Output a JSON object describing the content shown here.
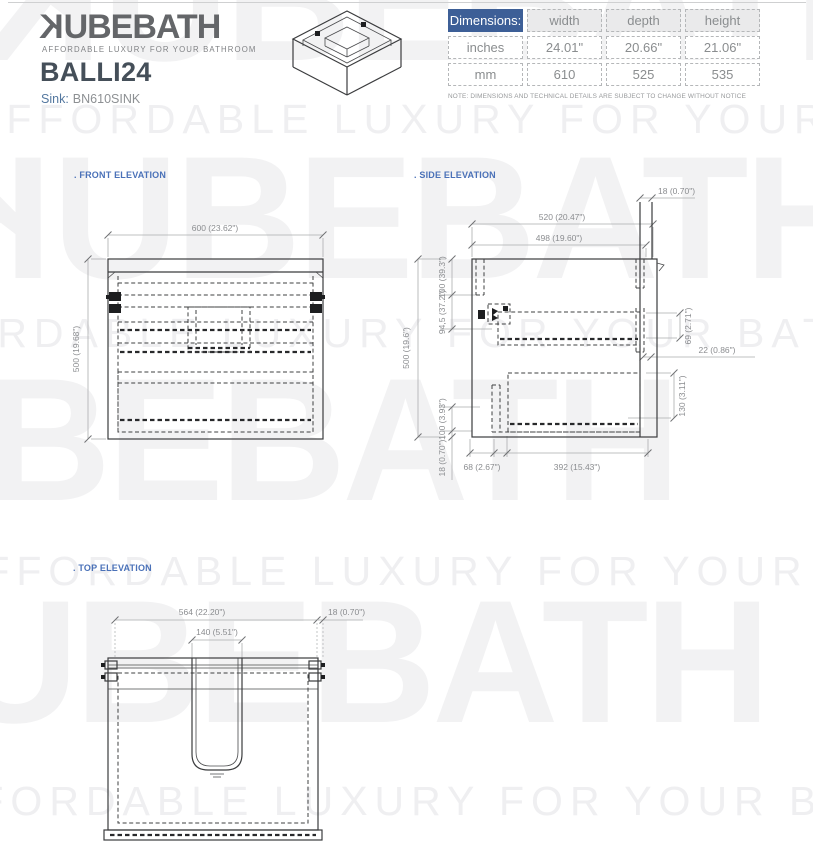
{
  "brand": {
    "logo_k": "K",
    "logo_rest": "UBEBATH",
    "tagline": "AFFORDABLE LUXURY FOR YOUR BATHROOM",
    "model": "BALLI24",
    "sink_label": "Sink:",
    "sink_value": "BN610SINK"
  },
  "spec_table": {
    "title": "Dimensions:",
    "columns": [
      "width",
      "depth",
      "height"
    ],
    "rows": [
      {
        "label": "inches",
        "values": [
          "24.01\"",
          "20.66\"",
          "21.06\""
        ]
      },
      {
        "label": "mm",
        "values": [
          "610",
          "525",
          "535"
        ]
      }
    ],
    "note": "NOTE: DIMENSIONS AND TECHNICAL DETAILS ARE SUBJECT TO CHANGE WITHOUT NOTICE"
  },
  "sections": {
    "front": ". FRONT ELEVATION",
    "side": ". SIDE ELEVATION",
    "top": ". TOP ELEVATION"
  },
  "front_dims": {
    "width": "600 (23.62\")",
    "height": "500 (19.68\")"
  },
  "side_dims": {
    "top_panel": "18 (0.70\")",
    "depth_outer": "520 (20.47\")",
    "depth_inner": "498 (19.60\")",
    "height": "500 (19.6\")",
    "left_top": "100 (39.3\")",
    "left_mid": "94,5 (37.2\")",
    "left_lower": "100 (3.93\")",
    "left_bottom": "18 (0.70\")",
    "right_top": "69 (2.71\")",
    "right_mid": "22 (0.86\")",
    "right_bottom": "130 (3.11\")",
    "bottom_left": "68 (2.67\")",
    "bottom_right": "392 (15.43\")"
  },
  "top_dims": {
    "width": "564 (22.20\")",
    "panel": "18 (0.70\")",
    "cutout": "140 (5.51\")"
  },
  "colors": {
    "accent_blue": "#3d5f97",
    "label_blue": "#4a71b8"
  },
  "watermark": {
    "logo_k": "K",
    "logo_rest": "UBEBATH",
    "tagline": "AFFORDABLE LUXURY FOR YOUR BATHROOM"
  }
}
